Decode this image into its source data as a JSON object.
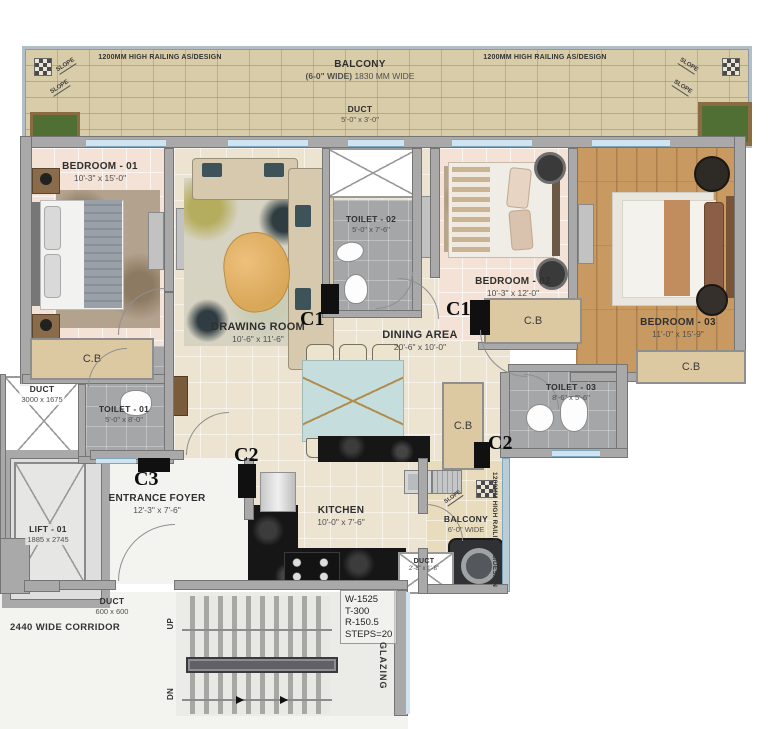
{
  "plan": {
    "balcony_top": {
      "name": "BALCONY",
      "size_bold": "(6-0\" WIDE)",
      "size": "1830 MM WIDE",
      "railing": "1200MM HIGH RAILING AS/DESIGN"
    },
    "rooms": {
      "bedroom1": {
        "name": "BEDROOM - 01",
        "dim": "10'-3\" x 15'-0\""
      },
      "bedroom2": {
        "name": "BEDROOM - 02",
        "dim": "10'-3\" x 12'-0\""
      },
      "bedroom3": {
        "name": "BEDROOM - 03",
        "dim": "11'-0\" x 15'-9\""
      },
      "drawing": {
        "name": "DRAWING ROOM",
        "dim": "10'-6\" x 11'-6\""
      },
      "dining": {
        "name": "DINING AREA",
        "dim": "20'-6\" x 10'-0\""
      },
      "kitchen": {
        "name": "KITCHEN",
        "dim": "10'-0\" x 7'-6\""
      },
      "foyer": {
        "name": "ENTRANCE FOYER",
        "dim": "12'-3\" x 7'-6\""
      },
      "toilet1": {
        "name": "TOILET - 01",
        "dim": "5'-0\" x 8'-0\""
      },
      "toilet2": {
        "name": "TOILET - 02",
        "dim": "5'-0\" x 7'-6\""
      },
      "toilet3": {
        "name": "TOILET - 03",
        "dim": "8'-6\" x 5'-6\""
      },
      "balcony2": {
        "name": "BALCONY",
        "dim": "6'-0\" WIDE"
      },
      "lift": {
        "name": "LIFT - 01",
        "dim": "1885 x 2745"
      },
      "duct_top": {
        "name": "DUCT",
        "dim": "5'-0\" x 3'-0\""
      },
      "duct_left": {
        "name": "DUCT",
        "dim": "3000 x 1675"
      },
      "duct_small": {
        "name": "DUCT",
        "dim": "2'-8\" x 1'-8\""
      },
      "duct_corridor": {
        "name": "DUCT",
        "dim": "600 x 600"
      }
    },
    "labels": {
      "cupboard": "C.B",
      "corridor": "2440 WIDE CORRIDOR",
      "railing_side": "1200MM HIGH RAILING AS/DESIGN",
      "glazing": "GLAZING",
      "slope": "SLOPE"
    },
    "columns": {
      "c1": "C1",
      "c2": "C2",
      "c3": "C3"
    },
    "stairs": {
      "up": "UP",
      "dn": "DN",
      "notes": [
        "W-1525",
        "T-300",
        "R-150.5",
        "STEPS=20"
      ]
    }
  },
  "colors": {
    "wall": "#a9a9a9",
    "floor_pink": "#f4e2d6",
    "floor_cream": "#ece3d1",
    "floor_wood": "#c89a62",
    "tile_gray": "#a4a6a8",
    "balcony_brick": "#d9cca8",
    "cupboard_tan": "#dcc9a2",
    "counter_black": "#101010",
    "window_blue": "#cfe4f0",
    "marble_white": "#f3f3f0"
  }
}
